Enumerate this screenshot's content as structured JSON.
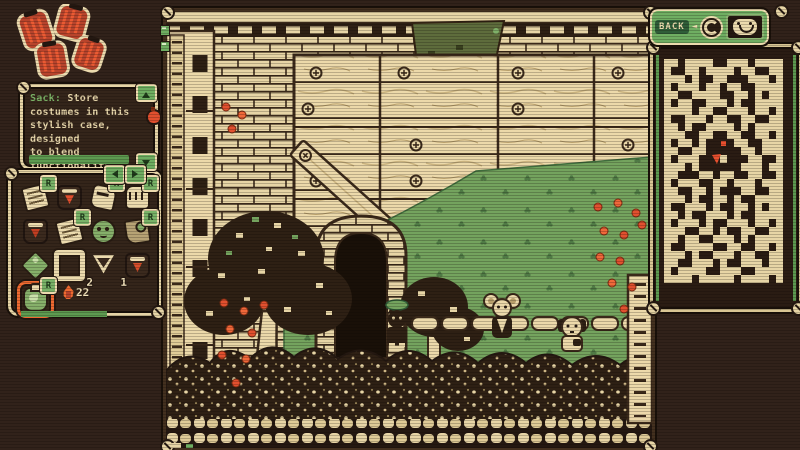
{
  "colors": {
    "bg": "#31221a",
    "cream": "#e7d5a6",
    "outline": "#241811",
    "ui_green": "#6fae62",
    "dark_green": "#2f5d38",
    "grass_green": "#74a35e",
    "olive": "#7b6a3c",
    "red": "#e2502f",
    "orange": "#ef6a31"
  },
  "description_panel": {
    "item_name": "Sack:",
    "line1": "Store",
    "line2": "costumes in this",
    "line3": "stylish case, designed",
    "line4": "to blend functionality",
    "line5": "and elegance"
  },
  "back_button": {
    "label": "BACK",
    "arrow": "◄"
  },
  "inventory": {
    "ember_count": "22",
    "slots": [
      {
        "icon": "costume-tag",
        "shape": "note",
        "badge": "R"
      },
      {
        "icon": "red-tunic",
        "shape": "vest",
        "accent": "#e2502f"
      },
      {
        "icon": "work-gloves",
        "shape": "glove",
        "badge": "R"
      },
      {
        "icon": "gauntlet",
        "shape": "fist",
        "badge": "R"
      },
      {
        "icon": "apron-tunic",
        "shape": "vest",
        "accent": "#c23e22"
      },
      {
        "icon": "letter",
        "shape": "note",
        "badge": "R"
      },
      {
        "icon": "frog-mask",
        "shape": "mask",
        "color": "#86b06a"
      },
      {
        "icon": "slingshot",
        "shape": "tool",
        "badge": "R"
      },
      {
        "icon": "green-boot",
        "shape": "gem",
        "color": "#86b06a"
      },
      {
        "icon": "display-frame",
        "shape": "frame",
        "count": "2"
      },
      {
        "icon": "funnel-charm",
        "shape": "funnel",
        "count": "1"
      },
      {
        "icon": "scarf-tunic",
        "shape": "vest",
        "accent": "#d94f2b"
      },
      {
        "icon": "leaf-satchel",
        "shape": "bag",
        "color": "#86b06a",
        "badge": "R",
        "selected": true
      }
    ]
  },
  "minimap": {
    "rows": [
      "##.####..###.####",
      "#..##.####.##..##",
      "###.#..##...###.#",
      "#.###.##.##..####",
      "##..####..##.#.##",
      "#.##..###.#..####",
      "####.##..###.##.#",
      "#..###.##..##..##",
      "##.#..####.#.####",
      "###..##..##..##.#",
      "#.##.#..r.##..###",
      "##..##.....##.###",
      "#.###..P#...##..#",
      "###.#......###.##",
      "##...##.##..##..#",
      "#.###..##.###.###",
      "##..##.#...##..##",
      "###.#..##.#..####",
      "#..###.#..##.#.##",
      "##.#..###.#..####",
      "#.###.#..###.##.#",
      "###..##.#..##..##",
      "##.##..###.#.####",
      "#..####..##..##.#",
      "###.#..###.##..##",
      "##..###.#..###.##",
      "#.####..###..####",
      "####.#####.####.#"
    ]
  }
}
